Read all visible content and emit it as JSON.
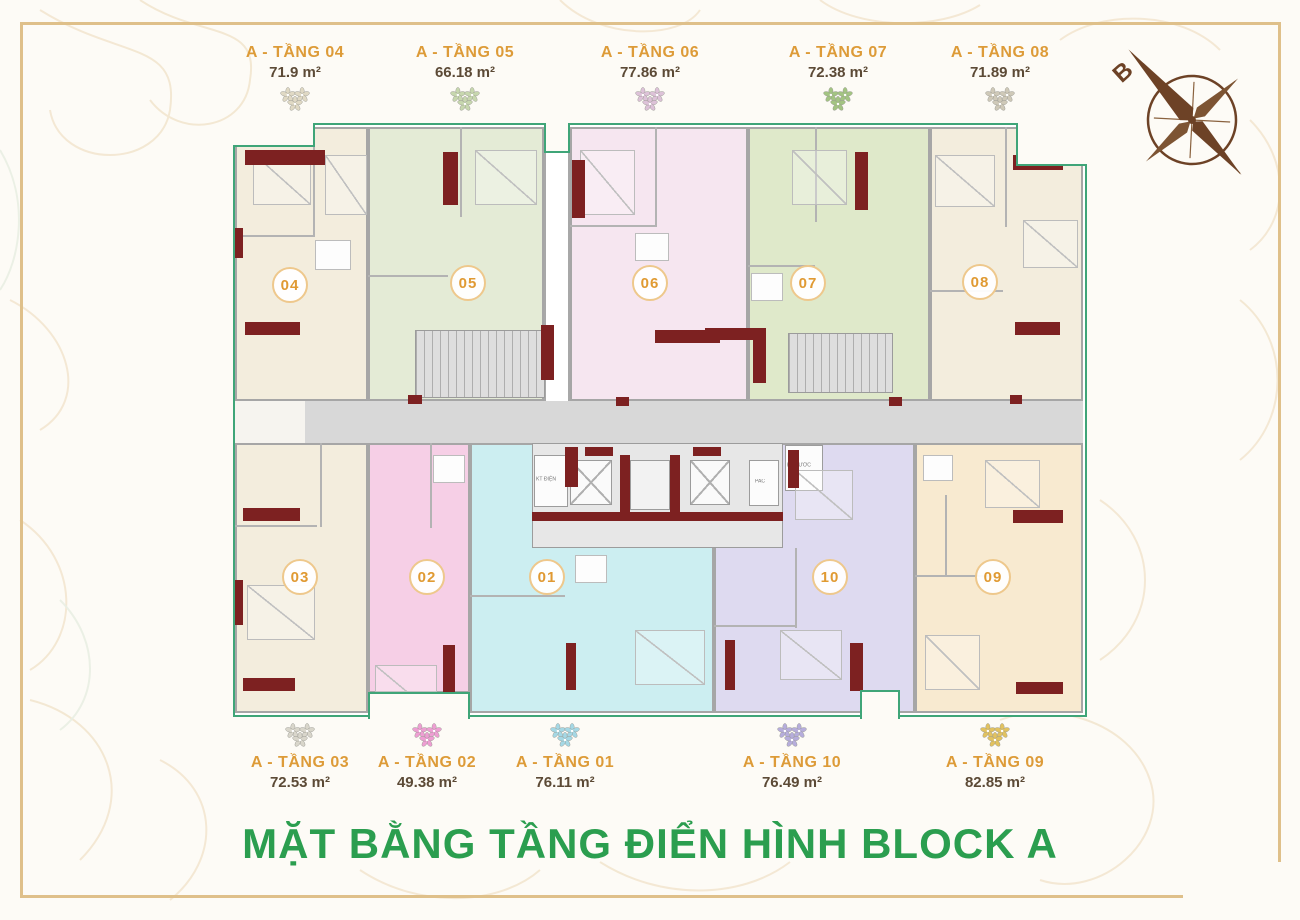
{
  "title": "MẶT BẰNG TẦNG ĐIỂN HÌNH BLOCK A",
  "compass": {
    "north_label": "B"
  },
  "plan": {
    "core_labels": {
      "electrical": "KT ĐIỆN",
      "water": "KT NƯỚC",
      "pac": "PAC"
    }
  },
  "colors": {
    "accent_green": "#2b9e4f",
    "boundary_green": "#3fa578",
    "label_gold": "#dd9b38",
    "shear_wall_maroon": "#7d2121",
    "frame_gold": "#dfc08a"
  },
  "units": [
    {
      "id": "04",
      "name": "A - TẦNG 04",
      "area": "71.9 m²",
      "badge": "04",
      "color": "#f3eddd",
      "flower_color": "#e0d9c4"
    },
    {
      "id": "05",
      "name": "A - TẦNG 05",
      "area": "66.18 m²",
      "badge": "05",
      "color": "#e4ebd6",
      "flower_color": "#c7d7ae"
    },
    {
      "id": "06",
      "name": "A - TẦNG 06",
      "area": "77.86 m²",
      "badge": "06",
      "color": "#f6e6f0",
      "flower_color": "#ddc2d8"
    },
    {
      "id": "07",
      "name": "A - TẦNG 07",
      "area": "72.38 m²",
      "badge": "07",
      "color": "#dfe9ca",
      "flower_color": "#a3c482"
    },
    {
      "id": "08",
      "name": "A - TẦNG 08",
      "area": "71.89 m²",
      "badge": "08",
      "color": "#f3eddd",
      "flower_color": "#cfc9b8"
    },
    {
      "id": "03",
      "name": "A - TẦNG 03",
      "area": "72.53 m²",
      "badge": "03",
      "color": "#f3eddd",
      "flower_color": "#d9d6cb"
    },
    {
      "id": "02",
      "name": "A - TẦNG 02",
      "area": "49.38 m²",
      "badge": "02",
      "color": "#f6cfe6",
      "flower_color": "#ee9ed3"
    },
    {
      "id": "01",
      "name": "A - TẦNG 01",
      "area": "76.11 m²",
      "badge": "01",
      "color": "#cceef1",
      "flower_color": "#a5d8e5"
    },
    {
      "id": "10",
      "name": "A - TẦNG 10",
      "area": "76.49 m²",
      "badge": "10",
      "color": "#dedaf0",
      "flower_color": "#b6addc"
    },
    {
      "id": "09",
      "name": "A - TẦNG 09",
      "area": "82.85 m²",
      "badge": "09",
      "color": "#f8ead0",
      "flower_color": "#e2c25f"
    }
  ]
}
